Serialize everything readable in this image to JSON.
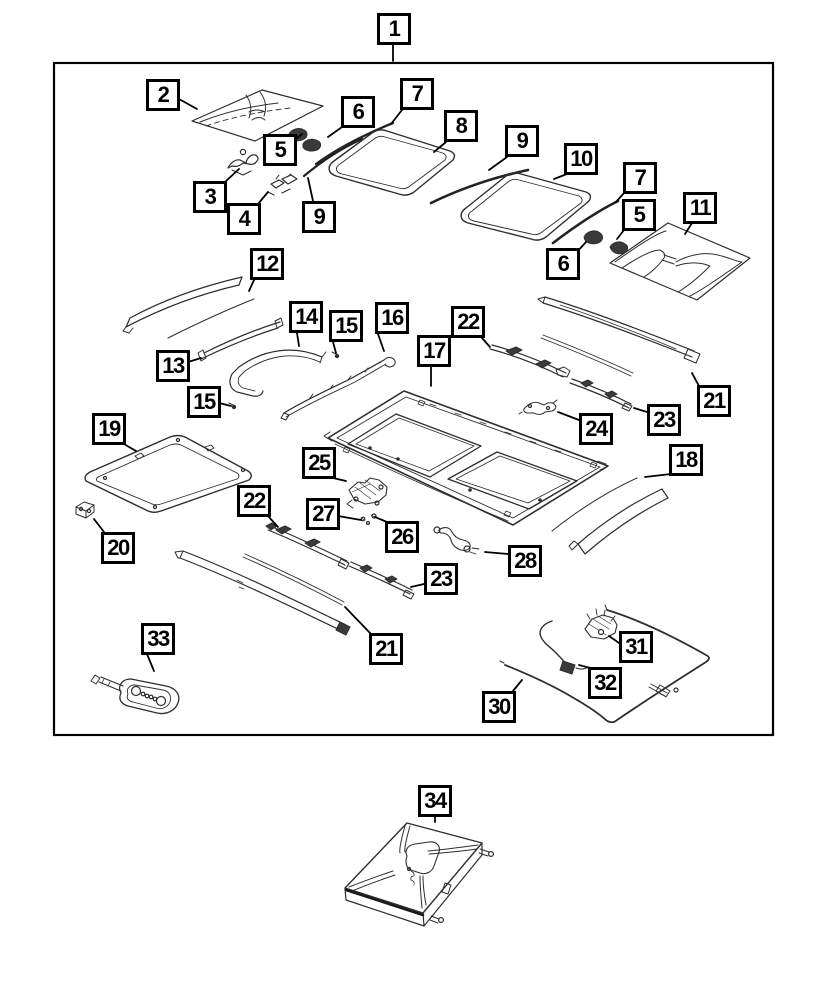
{
  "meta": {
    "document_type": "exploded-parts-diagram",
    "subject": "sunroof-assembly-exploded-view",
    "part_numbers_shown": [
      1,
      2,
      3,
      4,
      5,
      6,
      7,
      8,
      9,
      10,
      11,
      12,
      13,
      14,
      15,
      16,
      17,
      18,
      19,
      20,
      21,
      22,
      23,
      24,
      25,
      26,
      27,
      28,
      30,
      31,
      32,
      33,
      34
    ]
  },
  "colors": {
    "background": "#ffffff",
    "ink": "#000000",
    "part_line": "#2e2e2e",
    "dark_fill": "#3a3a3a"
  },
  "callouts": [
    {
      "label": "1",
      "x": 377,
      "y": 13,
      "leader": [
        [
          393,
          45
        ],
        [
          393,
          61
        ]
      ]
    },
    {
      "label": "2",
      "x": 146,
      "y": 79,
      "leader": [
        [
          179,
          99
        ],
        [
          197,
          109
        ]
      ]
    },
    {
      "label": "6",
      "x": 341,
      "y": 96,
      "leader": [
        [
          342,
          127
        ],
        [
          328,
          137
        ]
      ]
    },
    {
      "label": "5",
      "x": 263,
      "y": 134,
      "leader": [
        [
          295,
          140
        ],
        [
          302,
          134
        ]
      ]
    },
    {
      "label": "3",
      "x": 193,
      "y": 181,
      "leader": [
        [
          225,
          182
        ],
        [
          239,
          169
        ]
      ]
    },
    {
      "label": "4",
      "x": 227,
      "y": 203,
      "leader": [
        [
          258,
          204
        ],
        [
          268,
          192
        ]
      ]
    },
    {
      "label": "9",
      "x": 302,
      "y": 201,
      "leader": [
        [
          313,
          201
        ],
        [
          308,
          178
        ]
      ]
    },
    {
      "label": "7",
      "x": 400,
      "y": 78,
      "leader": [
        [
          402,
          110
        ],
        [
          391,
          124
        ]
      ]
    },
    {
      "label": "8",
      "x": 444,
      "y": 110,
      "leader": [
        [
          446,
          142
        ],
        [
          434,
          152
        ]
      ]
    },
    {
      "label": "9",
      "x": 505,
      "y": 125,
      "leader": [
        [
          507,
          157
        ],
        [
          489,
          170
        ]
      ]
    },
    {
      "label": "10",
      "x": 564,
      "y": 143,
      "leader": [
        [
          567,
          174
        ],
        [
          554,
          179
        ]
      ]
    },
    {
      "label": "7",
      "x": 623,
      "y": 162,
      "leader": [
        [
          624,
          193
        ],
        [
          616,
          202
        ]
      ]
    },
    {
      "label": "5",
      "x": 622,
      "y": 199,
      "leader": [
        [
          624,
          230
        ],
        [
          617,
          239
        ]
      ]
    },
    {
      "label": "11",
      "x": 683,
      "y": 192,
      "leader": [
        [
          692,
          223
        ],
        [
          685,
          234
        ]
      ]
    },
    {
      "label": "6",
      "x": 546,
      "y": 248,
      "leader": [
        [
          577,
          252
        ],
        [
          586,
          242
        ]
      ]
    },
    {
      "label": "12",
      "x": 250,
      "y": 248,
      "leader": [
        [
          254,
          280
        ],
        [
          249,
          291
        ]
      ]
    },
    {
      "label": "13",
      "x": 156,
      "y": 350,
      "leader": [
        [
          188,
          362
        ],
        [
          201,
          358
        ]
      ]
    },
    {
      "label": "14",
      "x": 289,
      "y": 301,
      "leader": [
        [
          297,
          333
        ],
        [
          299,
          346
        ]
      ]
    },
    {
      "label": "15",
      "x": 329,
      "y": 310,
      "leader": [
        [
          333,
          342
        ],
        [
          336,
          353
        ]
      ]
    },
    {
      "label": "16",
      "x": 375,
      "y": 302,
      "leader": [
        [
          378,
          334
        ],
        [
          384,
          351
        ]
      ]
    },
    {
      "label": "22",
      "x": 451,
      "y": 306,
      "leader": [
        [
          482,
          338
        ],
        [
          490,
          347
        ]
      ]
    },
    {
      "label": "17",
      "x": 417,
      "y": 335,
      "leader": [
        [
          431,
          367
        ],
        [
          431,
          386
        ]
      ]
    },
    {
      "label": "15",
      "x": 187,
      "y": 386,
      "leader": [
        [
          219,
          403
        ],
        [
          231,
          406
        ]
      ]
    },
    {
      "label": "19",
      "x": 92,
      "y": 413,
      "leader": [
        [
          124,
          444
        ],
        [
          136,
          451
        ]
      ]
    },
    {
      "label": "21",
      "x": 697,
      "y": 385,
      "leader": [
        [
          699,
          386
        ],
        [
          692,
          373
        ]
      ]
    },
    {
      "label": "23",
      "x": 647,
      "y": 404,
      "leader": [
        [
          647,
          412
        ],
        [
          634,
          408
        ]
      ]
    },
    {
      "label": "24",
      "x": 579,
      "y": 413,
      "leader": [
        [
          579,
          420
        ],
        [
          558,
          412
        ]
      ]
    },
    {
      "label": "18",
      "x": 669,
      "y": 444,
      "leader": [
        [
          671,
          474
        ],
        [
          645,
          477
        ]
      ]
    },
    {
      "label": "25",
      "x": 302,
      "y": 447,
      "leader": [
        [
          333,
          478
        ],
        [
          346,
          481
        ]
      ]
    },
    {
      "label": "22",
      "x": 237,
      "y": 485,
      "leader": [
        [
          268,
          516
        ],
        [
          278,
          527
        ]
      ]
    },
    {
      "label": "27",
      "x": 306,
      "y": 498,
      "leader": [
        [
          338,
          516
        ],
        [
          361,
          520
        ]
      ]
    },
    {
      "label": "26",
      "x": 385,
      "y": 521,
      "leader": [
        [
          387,
          522
        ],
        [
          375,
          517
        ]
      ]
    },
    {
      "label": "20",
      "x": 101,
      "y": 532,
      "leader": [
        [
          104,
          532
        ],
        [
          94,
          519
        ]
      ]
    },
    {
      "label": "23",
      "x": 424,
      "y": 563,
      "leader": [
        [
          424,
          584
        ],
        [
          411,
          587
        ]
      ]
    },
    {
      "label": "28",
      "x": 508,
      "y": 545,
      "leader": [
        [
          508,
          554
        ],
        [
          485,
          552
        ]
      ]
    },
    {
      "label": "33",
      "x": 141,
      "y": 623,
      "leader": [
        [
          147,
          654
        ],
        [
          154,
          671
        ]
      ]
    },
    {
      "label": "21",
      "x": 369,
      "y": 633,
      "leader": [
        [
          371,
          634
        ],
        [
          345,
          607
        ]
      ]
    },
    {
      "label": "31",
      "x": 619,
      "y": 631,
      "leader": [
        [
          619,
          643
        ],
        [
          609,
          636
        ]
      ]
    },
    {
      "label": "32",
      "x": 588,
      "y": 667,
      "leader": [
        [
          590,
          668
        ],
        [
          579,
          665
        ]
      ]
    },
    {
      "label": "30",
      "x": 482,
      "y": 691,
      "leader": [
        [
          513,
          691
        ],
        [
          522,
          680
        ]
      ]
    },
    {
      "label": "34",
      "x": 418,
      "y": 785,
      "leader": [
        [
          435,
          816
        ],
        [
          435,
          822
        ]
      ]
    }
  ]
}
